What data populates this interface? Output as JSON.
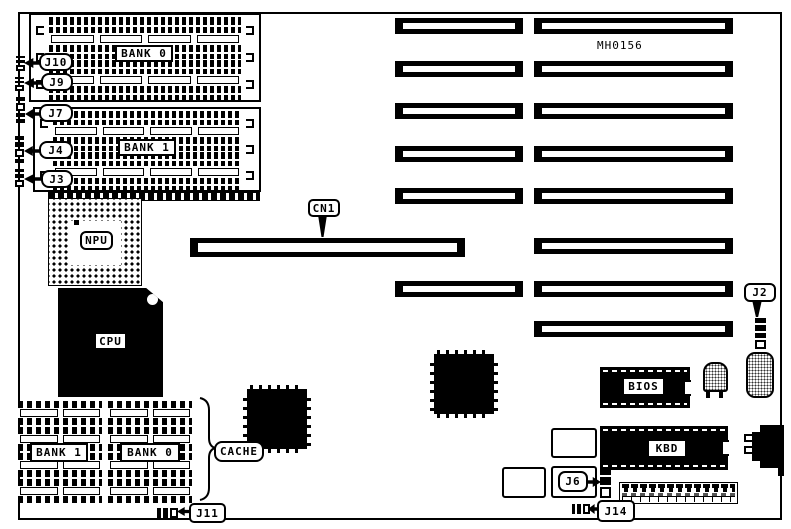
{
  "board": {
    "part_number": "MH0156",
    "callouts": {
      "j10": "J10",
      "j9": "J9",
      "j7": "J7",
      "j4": "J4",
      "j3": "J3",
      "j11": "J11",
      "cn1": "CN1",
      "j2": "J2",
      "j6": "J6",
      "j14": "J14",
      "cache": "CACHE"
    },
    "chips": {
      "npu": "NPU",
      "cpu": "CPU",
      "bios": "BIOS",
      "kbd": "KBD"
    },
    "memory": {
      "simm_bank0": "BANK 0",
      "simm_bank1": "BANK 1",
      "cache_bank1": "BANK 1",
      "cache_bank0": "BANK 0"
    },
    "colors": {
      "ink": "#000000",
      "paper": "#ffffff"
    }
  }
}
